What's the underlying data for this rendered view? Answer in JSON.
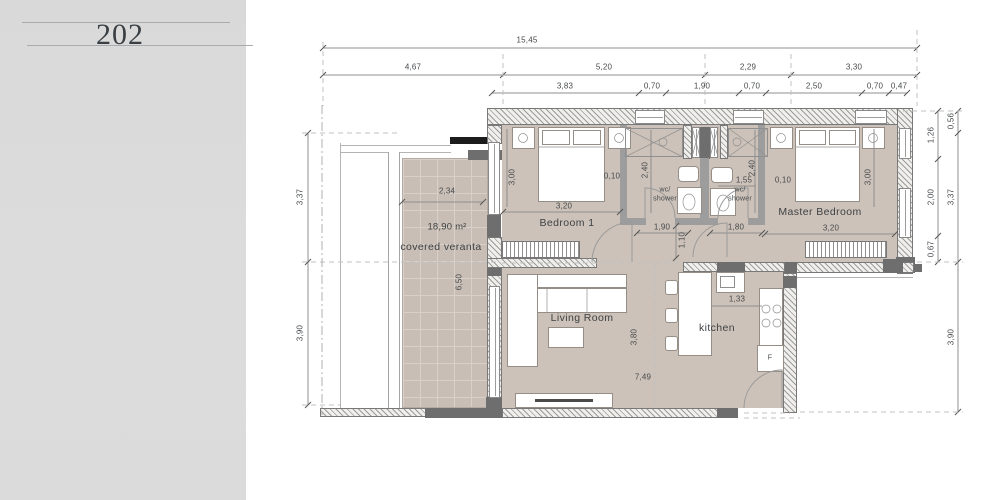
{
  "sidebar": {
    "unit_number": "202"
  },
  "plan": {
    "rooms": {
      "bedroom1": "Bedroom 1",
      "master_bedroom": "Master Bedroom",
      "living_room": "Living Room",
      "kitchen": "kitchen",
      "veranda": "covered veranta",
      "veranda_area": "18,90 m²",
      "wc_line1": "wc/",
      "wc_line2": "shower",
      "fridge": "F"
    },
    "dims": {
      "overall_width": "15,45",
      "top_row2": [
        "4,67",
        "5,20",
        "2,29",
        "3,30"
      ],
      "top_row3": [
        "3,83",
        "0,70",
        "1,90",
        "0,70",
        "2,50",
        "0,70",
        "0,47"
      ],
      "left_upper": "3,37",
      "left_lower": "3,90",
      "right_inner": [
        "1,26",
        "2,00",
        "0,67"
      ],
      "right_outer": [
        "0,56",
        "3,37",
        "3,90"
      ],
      "veranda_width": "2,34",
      "veranda_depth": "6,50",
      "bedroom1_depth": "3,00",
      "bedroom1_offset": "0,10",
      "bedroom1_width": "3,20",
      "wc1_depth": "2,40",
      "wc2_depth": "2,40",
      "wc2_width": "1,55",
      "master_offset": "0,10",
      "master_depth": "3,00",
      "master_width": "3,20",
      "hall_left": "1,90",
      "hall_right": "1,80",
      "hall_width": "1,10",
      "living_depth": "3,80",
      "living_width": "7,49",
      "kitchen_gap": "1,33"
    }
  }
}
